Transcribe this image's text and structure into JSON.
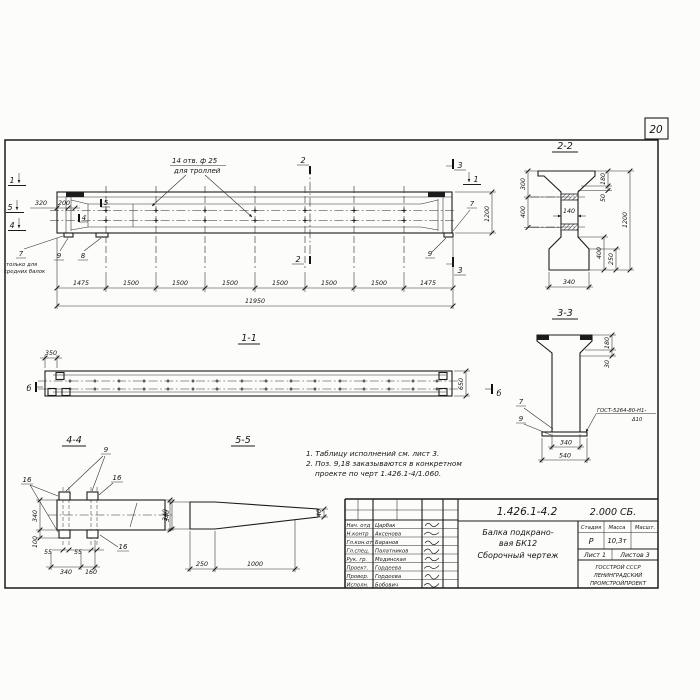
{
  "page": {
    "sheet_number": "20"
  },
  "main_view": {
    "cut_left": [
      "1",
      "5",
      "4"
    ],
    "dim_320": "320",
    "dim_200": "200",
    "inner_cut_5": "5",
    "inner_cut_4": "4",
    "holes_note_1": "14 отв. ф 25",
    "holes_note_2": "для троллей",
    "pos9": "9",
    "pos8": "8",
    "pos7": "7",
    "pos7_note_1": "только для",
    "pos7_note_2": "средних балок",
    "cut2": "2",
    "cut3": "3",
    "cut1_right": "1",
    "dim_1200": "1200",
    "bottom_dims": [
      "1475",
      "1500",
      "1500",
      "1500",
      "1500",
      "1500",
      "1500",
      "1475"
    ],
    "dim_total": "11950"
  },
  "section_1_1": {
    "title": "1-1",
    "dim_350": "350",
    "dim_650": "650",
    "marker": "б"
  },
  "section_2_2": {
    "title": "2-2",
    "left_dims": [
      "300",
      "400"
    ],
    "dim_web": "140",
    "right_dims": [
      "180",
      "50",
      "1200",
      "400",
      "250"
    ],
    "dim_bottom": "340"
  },
  "section_3_3": {
    "title": "3-3",
    "pos7": "7",
    "pos9": "9",
    "weld_note_1": "ГОСТ-5264-80-Н1-",
    "weld_note_2": "Δ10",
    "dim_180": "180",
    "dim_30": "30",
    "dim_340": "340",
    "dim_540": "540"
  },
  "detail_4_4": {
    "title": "4-4",
    "pos9": "9",
    "pos16": "16",
    "left_dims": [
      "340",
      "100"
    ],
    "bottom_dims": [
      "55",
      "55",
      "340",
      "160"
    ],
    "right_dim": "340"
  },
  "detail_5_5": {
    "title": "5-5",
    "left_dim": "340",
    "bottom_dims": [
      "250",
      "1000"
    ],
    "right_dim": "40"
  },
  "notes": {
    "n1": "1. Таблицу исполнений см. лист 3.",
    "n2": "2. Поз. 9,18 заказываются в конкретном",
    "n3": "проекте по черт 1.426.1-4/1.060."
  },
  "title_block": {
    "doc_number": "1.426.1-4.2",
    "doc_code": "2.000 СБ.",
    "title_lines": [
      "Балка подкрано-",
      "вая БК12",
      "Сборочный чертеж"
    ],
    "stage_headers": [
      "Стадия",
      "Масса",
      "Масшт."
    ],
    "stage": "Р",
    "mass": "10,3т",
    "sheet_info": [
      "Лист 1",
      "Листов 3"
    ],
    "organization": [
      "ГОССТРОЙ СССР",
      "ЛЕНИНГРАДСКИЙ",
      "ПРОМСТРОЙПРОЕКТ"
    ],
    "personnel": [
      {
        "role": "Нач. отд",
        "name": "Царбак"
      },
      {
        "role": "Н.контр",
        "name": "Аксенова"
      },
      {
        "role": "Гл.кон.от",
        "name": "Баранов"
      },
      {
        "role": "Гл.спец.",
        "name": "Палатников"
      },
      {
        "role": "Рук. гр.",
        "name": "Мединская"
      },
      {
        "role": "Проект.",
        "name": "Гордеева"
      },
      {
        "role": "Провер.",
        "name": "Гордеева"
      },
      {
        "role": "Исполн.",
        "name": "Бобович"
      }
    ]
  }
}
